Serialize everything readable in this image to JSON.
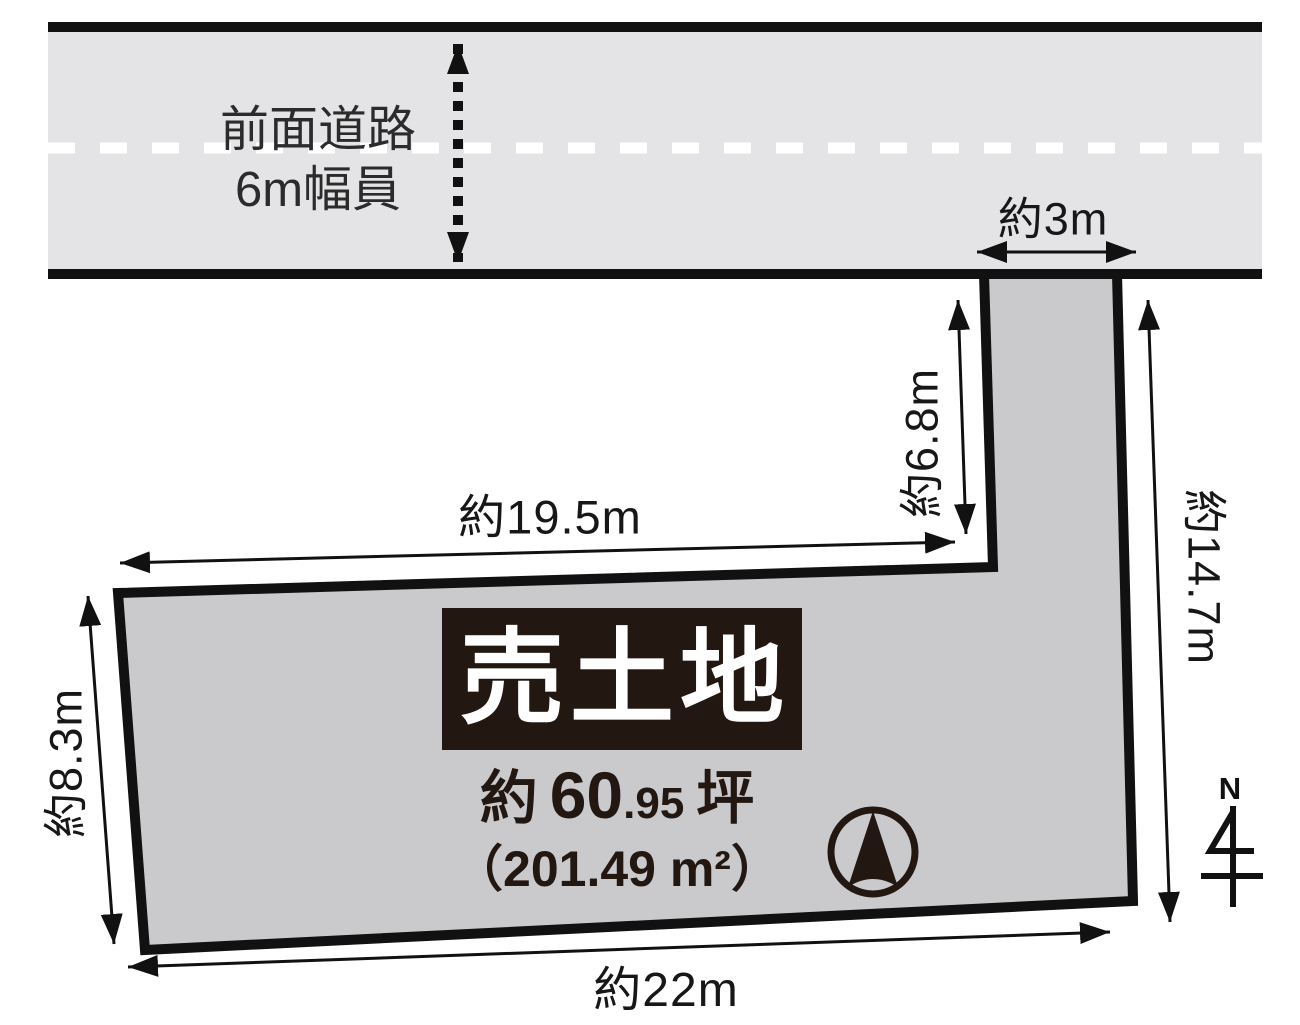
{
  "diagram": {
    "road": {
      "name_line1": "前面道路",
      "name_line2": "6m幅員"
    },
    "dimensions": {
      "approach_width": "約3m",
      "approach_depth": "約6.8m",
      "upper_edge": "約19.5m",
      "left_edge": "約8.3m",
      "bottom_edge": "約22m",
      "right_edge": "約14.7m"
    },
    "parcel": {
      "sale_label": "売土地",
      "area_tsubo_prefix": "約",
      "area_tsubo_int": "60",
      "area_tsubo_frac": ".95",
      "area_tsubo_unit": "坪",
      "area_sqm": "（201.49 m²）"
    },
    "compass": {
      "north_label": "N"
    },
    "colors": {
      "road_fill": "#e4e4e6",
      "parcel_fill": "#cacacc",
      "ink": "#171717",
      "sale_box_bg": "#231712",
      "sale_box_text": "#ffffff"
    }
  }
}
